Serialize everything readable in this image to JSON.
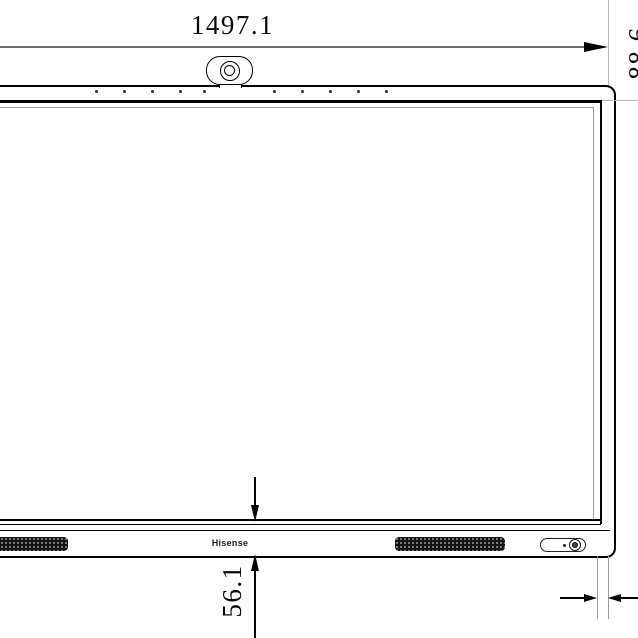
{
  "drawing": {
    "type": "technical-dimension-drawing",
    "view": "front",
    "brand_logo": "Hisense",
    "dimensions": {
      "overall_width_mm": "1497.1",
      "bottom_bar_height_mm": "56.1",
      "depth_mm": "88.6"
    },
    "colors": {
      "line": "#000000",
      "dim_line": "#6e6e6e",
      "extension_line": "#8a8a8a",
      "grille_fill": "#161616",
      "background": "#ffffff"
    }
  }
}
